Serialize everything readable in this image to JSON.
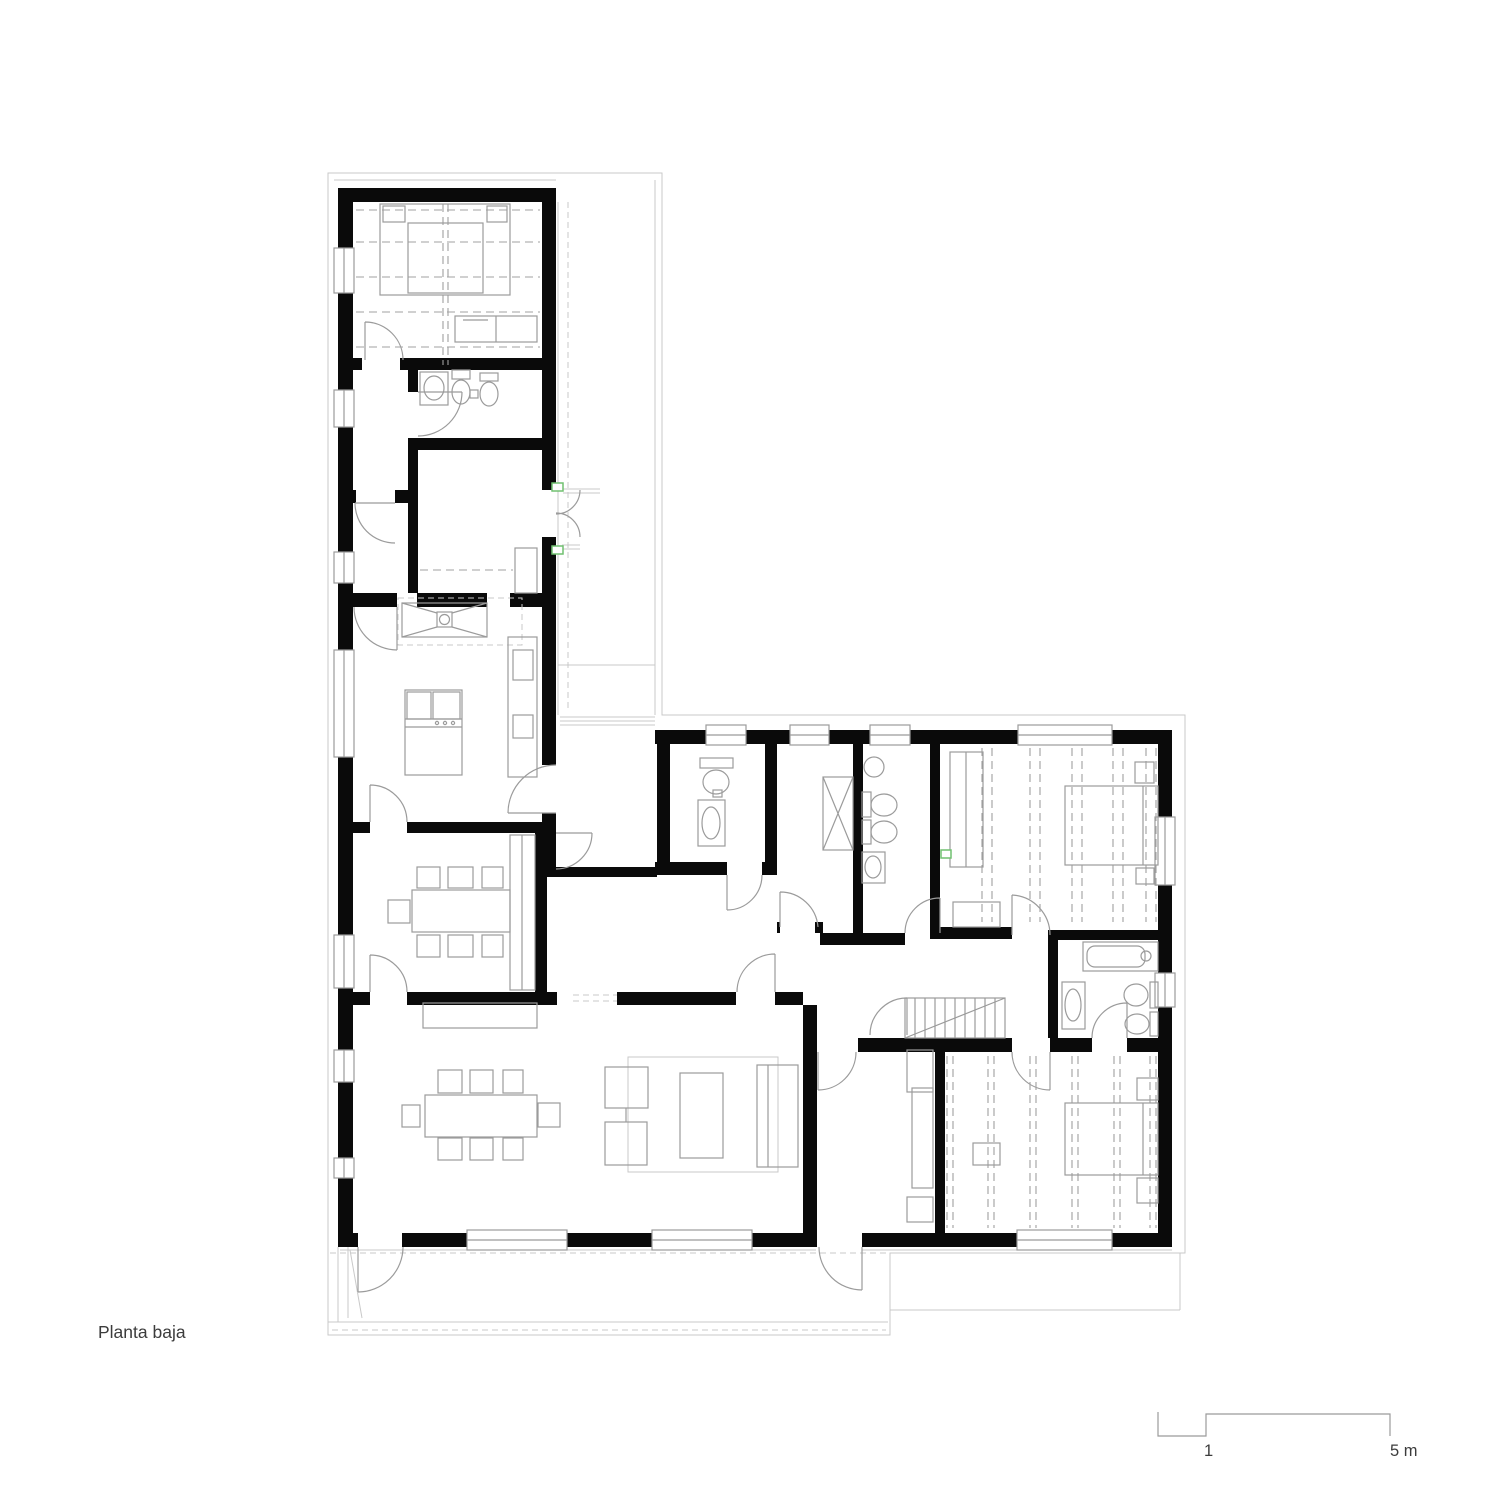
{
  "title": {
    "label": "Planta baja"
  },
  "scale_bar": {
    "tick_1": "1",
    "tick_5": "5 m"
  },
  "colors": {
    "walls": "#0a0a0a",
    "thin": "#9b9b9b",
    "light": "#c9c9c9",
    "dash": "#a0a0a0",
    "green": "#71c171",
    "text": "#3c3c3c"
  }
}
